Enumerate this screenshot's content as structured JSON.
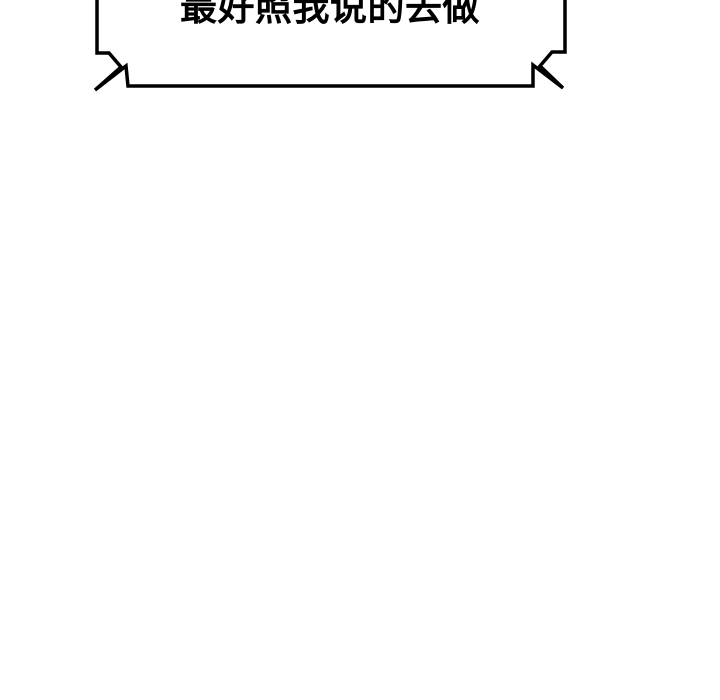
{
  "bubble": {
    "text": "最好照我说的去做"
  },
  "colors": {
    "background": "#ffffff",
    "bubble_fill": "#ffffff",
    "bubble_border": "#000000",
    "text": "#000000"
  }
}
